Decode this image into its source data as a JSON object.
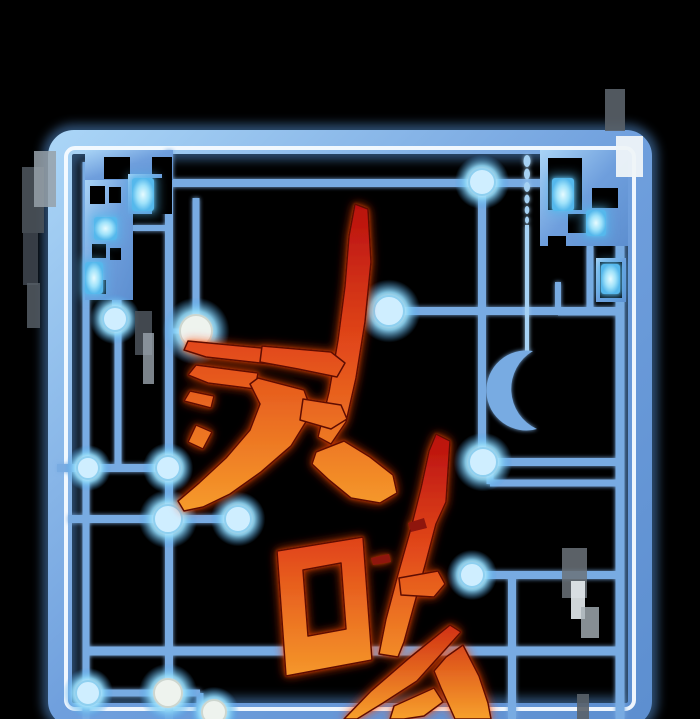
{
  "scene": {
    "width": 700,
    "height": 719,
    "background": "#000000",
    "description": "Webtoon cover art: glowing blue sci-fi circuit-board frame on black, with aggressive red-to-orange Korean brush calligraphy title overlapping it"
  },
  "title": {
    "visible_characters": [
      "전",
      "마"
    ],
    "partial_third_character": "top diagonal strokes (ㅅ-shape) of a third character cut off at bottom edge",
    "style": "jagged brush calligraphy, rotated, red top fading to orange bottom",
    "gradient_top": "#b90f0f",
    "gradient_mid": "#e2491a",
    "gradient_bottom": "#f7a02c",
    "outline_color": "#5e0b06",
    "glow_color": "#ff3c00"
  },
  "palette": {
    "background": "#000000",
    "frame_blue_light": "#a6d2f4",
    "frame_blue_dark": "#5d8fd0",
    "frame_white_stripe": "#f6fbff",
    "circuit_line": "#78abe2",
    "circuit_line_bright": "#a6d2f4",
    "node_core": "#ffffff",
    "node_glow": "#8fd8f8",
    "glow_cell": "#baf0ff",
    "glitch_gray": "#5a6269"
  },
  "frame": {
    "outer": {
      "x": 60,
      "y": 142,
      "w": 580,
      "h": 573,
      "rx": 14,
      "band_width": 24
    },
    "stripe": {
      "x": 66,
      "y": 148,
      "w": 568,
      "h": 561,
      "rx": 9,
      "width": 4
    }
  },
  "circuit": {
    "segments": [
      [
        88,
        183,
        545,
        183,
        8
      ],
      [
        169,
        150,
        169,
        719,
        8
      ],
      [
        118,
        240,
        118,
        468,
        7
      ],
      [
        196,
        198,
        196,
        331,
        7
      ],
      [
        169,
        331,
        196,
        331,
        5
      ],
      [
        385,
        311,
        622,
        311,
        8
      ],
      [
        482,
        183,
        482,
        463,
        8
      ],
      [
        483,
        462,
        620,
        462,
        8
      ],
      [
        490,
        462,
        490,
        484,
        7
      ],
      [
        490,
        483,
        620,
        483,
        7
      ],
      [
        57,
        468,
        169,
        468,
        8
      ],
      [
        68,
        519,
        238,
        519,
        8
      ],
      [
        86,
        162,
        86,
        719,
        7
      ],
      [
        85,
        651,
        622,
        651,
        9
      ],
      [
        512,
        577,
        512,
        719,
        8
      ],
      [
        473,
        575,
        620,
        575,
        8
      ],
      [
        620,
        205,
        620,
        719,
        9
      ],
      [
        88,
        693,
        200,
        693,
        7
      ],
      [
        200,
        693,
        200,
        712,
        7
      ],
      [
        200,
        712,
        218,
        712,
        7
      ],
      [
        133,
        228,
        169,
        228,
        6
      ],
      [
        115,
        300,
        115,
        319,
        6
      ],
      [
        590,
        246,
        590,
        312,
        7
      ],
      [
        558,
        282,
        558,
        312,
        6
      ],
      [
        558,
        312,
        622,
        312,
        7
      ]
    ],
    "thin_segments": [
      [
        527,
        225,
        527,
        352,
        4
      ]
    ],
    "teardrops": [
      [
        527,
        161,
        3.5,
        6
      ],
      [
        527,
        174,
        3,
        5.5
      ],
      [
        527,
        187,
        3,
        5
      ],
      [
        527,
        199,
        2.6,
        4.5
      ],
      [
        527,
        210,
        2.3,
        4
      ],
      [
        527,
        220,
        2,
        3.5
      ]
    ],
    "crescent_path": "M533,351 A40,40 0 1 0 537,429 A44,44 0 0 1 533,351 Z"
  },
  "mazes": [
    {
      "kind": "base",
      "x": 85,
      "y": 150,
      "w": 88,
      "h": 30
    },
    {
      "kind": "hole",
      "x": 104,
      "y": 157,
      "w": 26,
      "h": 22
    },
    {
      "kind": "hole",
      "x": 152,
      "y": 157,
      "w": 20,
      "h": 22
    },
    {
      "kind": "base",
      "x": 85,
      "y": 180,
      "w": 48,
      "h": 120
    },
    {
      "kind": "hole",
      "x": 90,
      "y": 186,
      "w": 15,
      "h": 18
    },
    {
      "kind": "hole",
      "x": 109,
      "y": 187,
      "w": 12,
      "h": 16
    },
    {
      "kind": "hole",
      "x": 92,
      "y": 244,
      "w": 14,
      "h": 14
    },
    {
      "kind": "hole",
      "x": 110,
      "y": 248,
      "w": 11,
      "h": 12
    },
    {
      "kind": "hole",
      "x": 88,
      "y": 280,
      "w": 18,
      "h": 14
    },
    {
      "kind": "base",
      "x": 128,
      "y": 174,
      "w": 34,
      "h": 40
    },
    {
      "kind": "hole",
      "x": 152,
      "y": 178,
      "w": 20,
      "h": 36
    },
    {
      "kind": "glow",
      "x": 132,
      "y": 178,
      "w": 22,
      "h": 33
    },
    {
      "kind": "glow",
      "x": 94,
      "y": 217,
      "w": 23,
      "h": 23
    },
    {
      "kind": "glow",
      "x": 85,
      "y": 262,
      "w": 18,
      "h": 32
    },
    {
      "kind": "base",
      "x": 540,
      "y": 150,
      "w": 88,
      "h": 96
    },
    {
      "kind": "hole",
      "x": 548,
      "y": 158,
      "w": 34,
      "h": 52
    },
    {
      "kind": "hole",
      "x": 592,
      "y": 188,
      "w": 26,
      "h": 20
    },
    {
      "kind": "hole",
      "x": 568,
      "y": 214,
      "w": 19,
      "h": 19
    },
    {
      "kind": "hole",
      "x": 548,
      "y": 236,
      "w": 18,
      "h": 10
    },
    {
      "kind": "glow",
      "x": 552,
      "y": 178,
      "w": 22,
      "h": 33
    },
    {
      "kind": "glow",
      "x": 586,
      "y": 210,
      "w": 20,
      "h": 26
    },
    {
      "kind": "base",
      "x": 596,
      "y": 258,
      "w": 30,
      "h": 44
    },
    {
      "kind": "hole",
      "x": 600,
      "y": 262,
      "w": 22,
      "h": 36
    },
    {
      "kind": "glow",
      "x": 601,
      "y": 264,
      "w": 19,
      "h": 30
    }
  ],
  "nodes": [
    [
      482,
      182,
      13,
      "cyan"
    ],
    [
      389,
      311,
      15,
      "cyan"
    ],
    [
      196,
      331,
      16,
      "white"
    ],
    [
      115,
      319,
      12,
      "cyan"
    ],
    [
      88,
      468,
      11,
      "cyan"
    ],
    [
      168,
      468,
      12,
      "cyan"
    ],
    [
      168,
      519,
      14,
      "cyan"
    ],
    [
      238,
      519,
      13,
      "cyan"
    ],
    [
      483,
      462,
      14,
      "cyan"
    ],
    [
      472,
      575,
      12,
      "cyan"
    ],
    [
      88,
      693,
      12,
      "cyan"
    ],
    [
      168,
      693,
      14,
      "white"
    ],
    [
      214,
      712,
      12,
      "white"
    ]
  ],
  "glitch_rects": [
    [
      22,
      167,
      22,
      66,
      "#4b535b",
      0.9
    ],
    [
      34,
      151,
      22,
      56,
      "#97a1a9",
      0.85
    ],
    [
      23,
      233,
      15,
      52,
      "#3d444c",
      0.9
    ],
    [
      27,
      283,
      13,
      45,
      "#555d65",
      0.85
    ],
    [
      135,
      311,
      17,
      44,
      "#495058",
      0.9
    ],
    [
      143,
      333,
      11,
      51,
      "#9aa4ac",
      0.8
    ],
    [
      605,
      89,
      20,
      42,
      "#5a6269",
      0.9
    ],
    [
      616,
      136,
      27,
      41,
      "#eef4f8",
      0.95
    ],
    [
      562,
      548,
      25,
      50,
      "#6b7279",
      0.85
    ],
    [
      571,
      581,
      14,
      38,
      "#e6ecef",
      0.9
    ],
    [
      581,
      607,
      18,
      31,
      "#a8b1b8",
      0.8
    ],
    [
      577,
      694,
      12,
      25,
      "#5a6269",
      0.9
    ]
  ],
  "title_strokes": {
    "char1": {
      "grad": [
        203,
        520
      ],
      "polys": [
        "355,204 368,209 371,262 365,322 356,378 346,422 331,444 318,437 329,392 338,340 345,286 349,236",
        "188,341 262,348 318,355 320,369 260,363 206,357 184,350",
        "196,365 258,373 255,389 208,383 188,375",
        "190,391 214,396 211,408 184,401",
        "262,346 331,352 345,363 337,377 298,369 260,362",
        "258,378 304,390 312,412 291,446 261,472 230,494 203,507 184,511 178,501 199,483 226,458 250,430 260,404 250,384",
        "196,425 212,432 203,449 188,442",
        "303,399 341,405 347,419 331,429 300,420",
        "316,452 344,441 370,457 393,475 397,493 380,503 351,498 329,480 312,464"
      ]
    },
    "char2": {
      "grad": [
        434,
        690
      ],
      "box_path": "M277,551 L363,537 L372,660 L286,676 Z M303,570 L341,563 L346,629 L308,636 Z",
      "polys": [
        "436,434 450,441 446,502 436,524 426,562 415,602 404,642 398,657 379,654 386,619 398,574 411,528 421,488 429,451",
        "399,578 438,571 445,584 434,597 401,595"
      ],
      "specks": [
        "408,523 424,518 427,528 411,532",
        "371,558 389,554 391,562 373,565"
      ]
    },
    "char3": {
      "grad": [
        620,
        719
      ],
      "polys": [
        "450,625 461,632 417,681 383,703 357,719 344,719 371,691 408,659",
        "446,657 463,645 479,676 488,703 491,719 455,719 441,688 434,671",
        "394,706 434,688 443,702 424,716 404,719 390,719"
      ]
    }
  }
}
